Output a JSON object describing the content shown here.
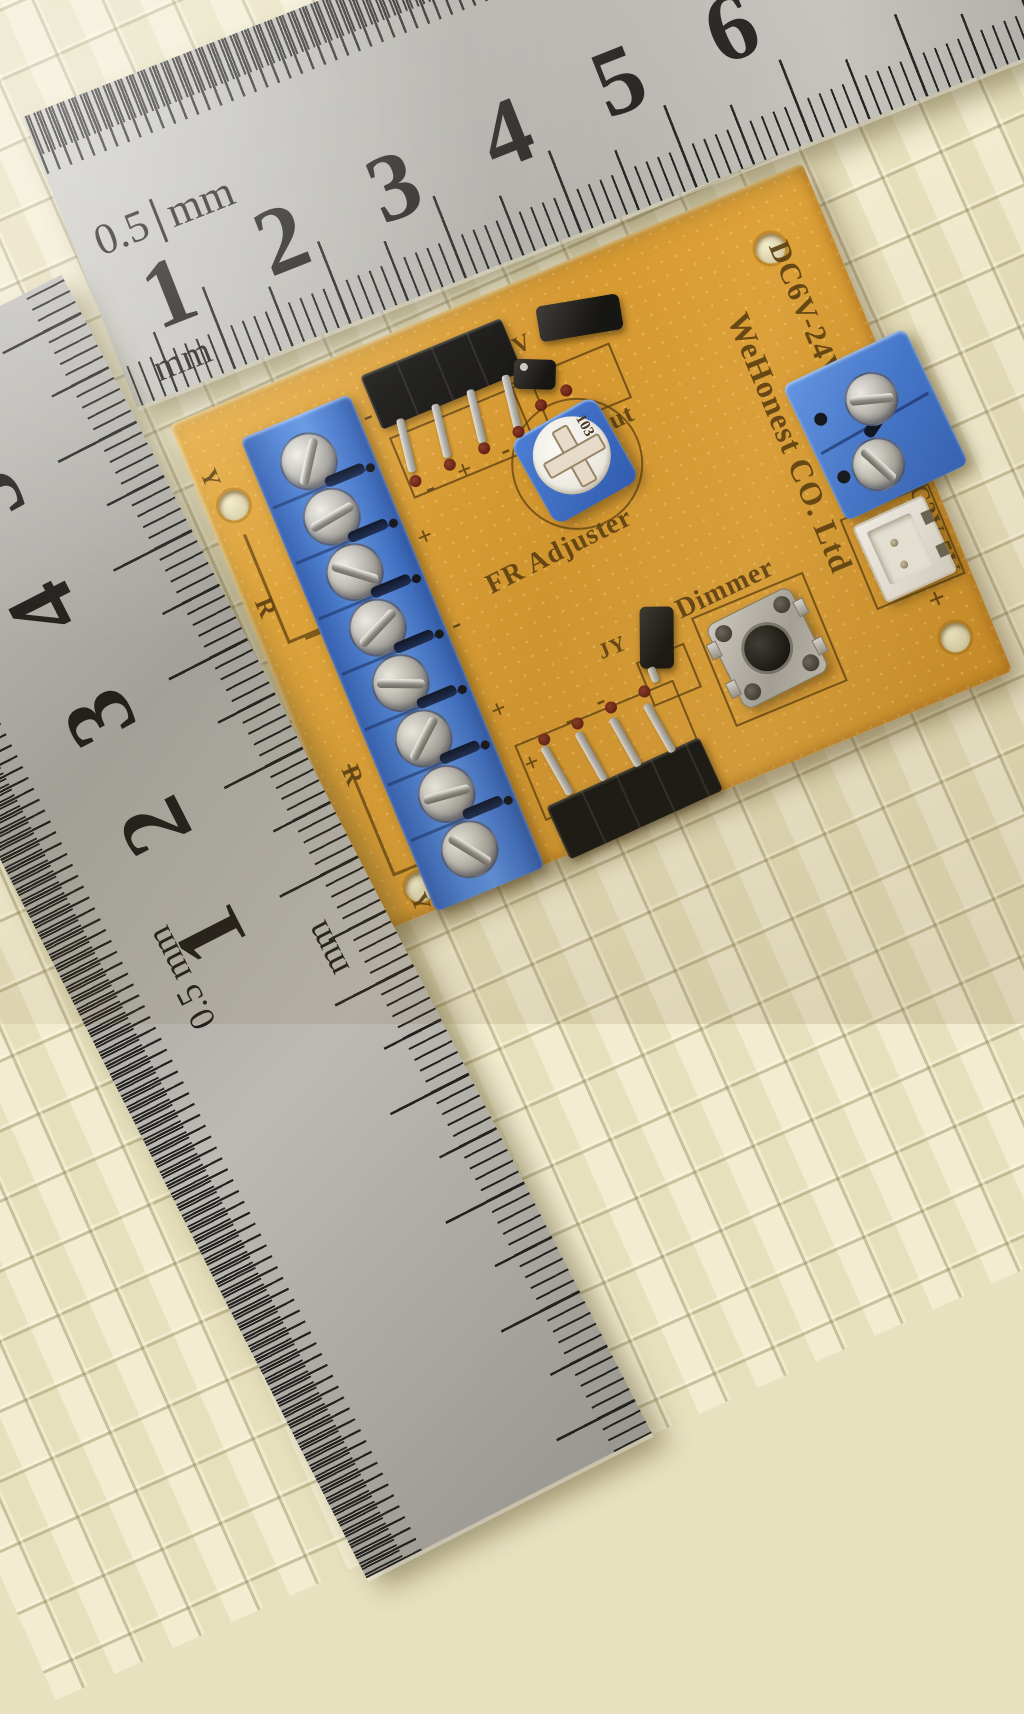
{
  "colors": {
    "mat": "#ece5c3",
    "metal": "#b7b5af",
    "tick": "#24221e",
    "amber": "#d6982f",
    "blue": "#4a7fd4",
    "silk": "#5d4011",
    "pad": "#611f12"
  },
  "rulers": {
    "top": {
      "numbers": [
        "1",
        "2",
        "3",
        "4",
        "5",
        "6"
      ],
      "half_scale_value": "0.5",
      "half_scale_unit": "mm",
      "mm_scale_unit": "mm"
    },
    "left": {
      "numbers": [
        "5",
        "4",
        "3",
        "2",
        "1"
      ],
      "mm_scale_unit": "mm",
      "half_scale_label": "0.5 mm"
    }
  },
  "pcb": {
    "branding": {
      "power_rating": "DC6V-24V +",
      "manufacturer": "WeHonest CO. Ltd",
      "aux_power": "DC3V-5V",
      "aux_minus": "-",
      "aux_plus": "+"
    },
    "labels": {
      "jumper_12v": "12V",
      "jumper_3v": "3V",
      "j_output": "J-output",
      "fr_adjuster": "FR Adjuster",
      "trimpot_code": "103",
      "dimmer": "Dimmer",
      "jy": "JY",
      "y_top": "Y",
      "y_bottom": "Y",
      "r_upper": "R",
      "r_lower": "R",
      "marks": {
        "top_header": [
          "-",
          "+",
          "-",
          "-"
        ],
        "bottom_header": [
          "-",
          "+",
          "-",
          "-"
        ],
        "strip_column": [
          "-",
          "+",
          "-",
          "+"
        ]
      }
    },
    "components": {
      "left_terminal_positions": 8,
      "right_terminal_positions": 2,
      "top_header_pins": 4,
      "bottom_header_pins": 4
    }
  }
}
